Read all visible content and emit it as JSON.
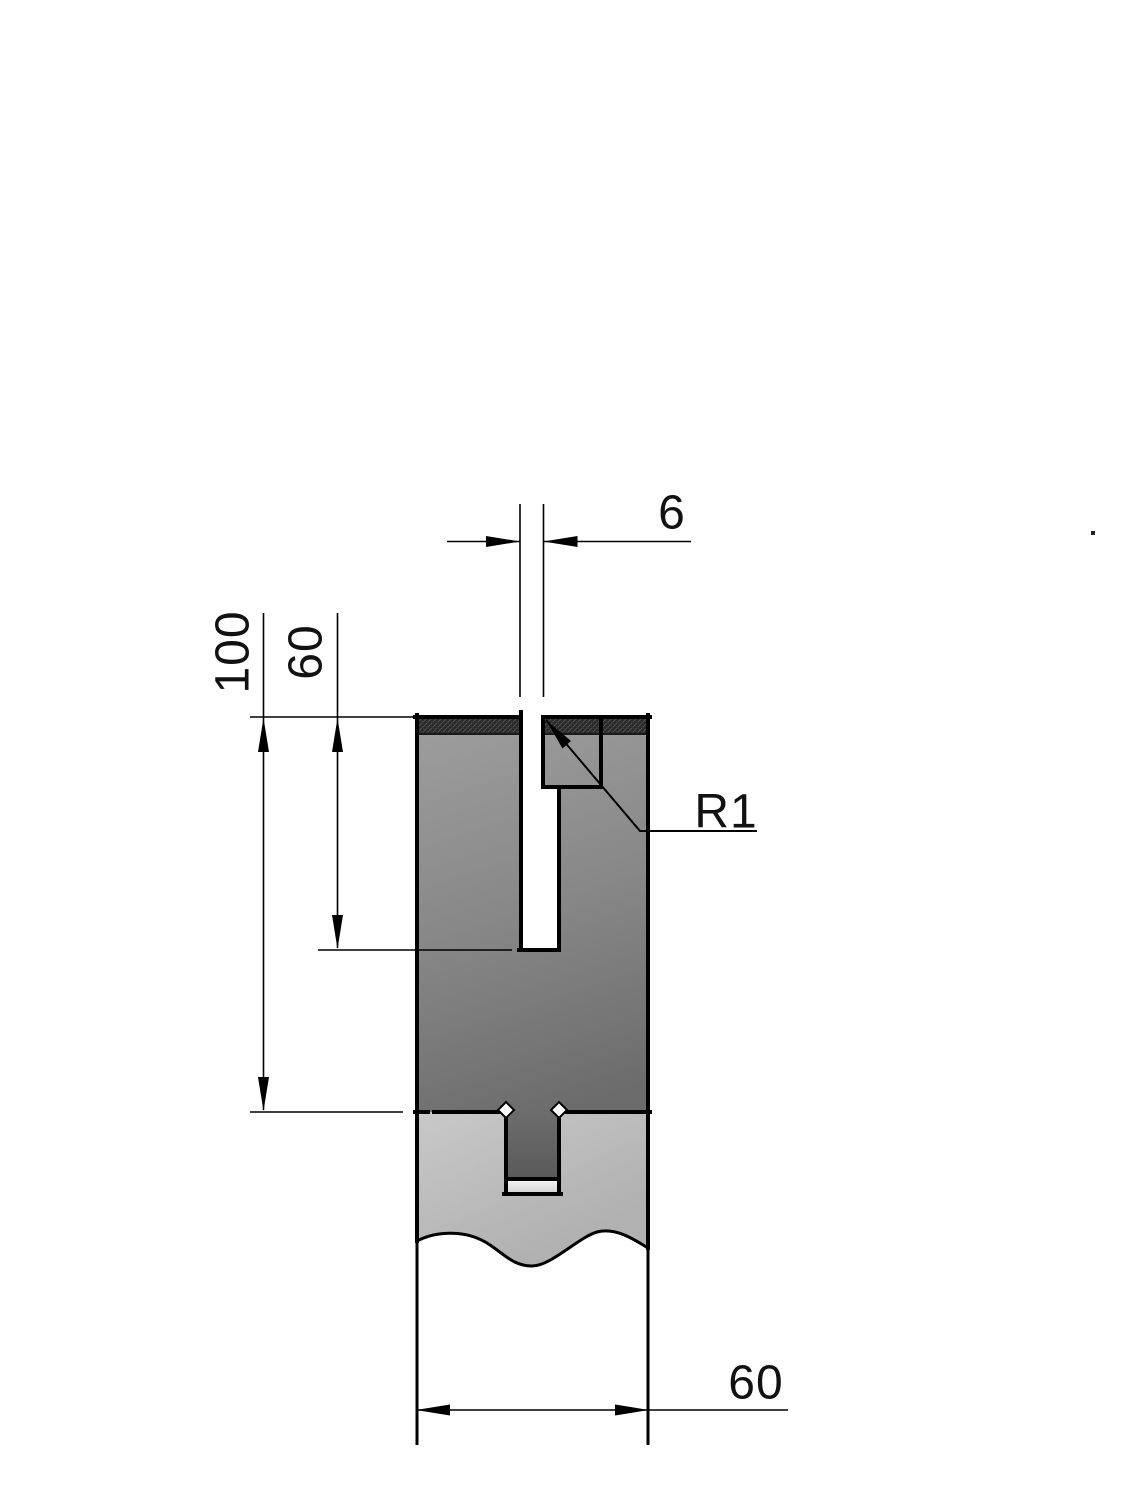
{
  "drawing": {
    "type": "technical-section-drawing",
    "dims": {
      "slot_width": "6",
      "overall_height": "100",
      "slot_depth": "60",
      "body_width": "60",
      "slot_radius": "R1"
    },
    "colors": {
      "background": "#ffffff",
      "line": "#000000",
      "die_gray_top": "#9e9e9e",
      "die_gray_bottom": "#6c6c6c",
      "holder_gray_top": "#c8c8c8",
      "holder_gray_bottom": "#b1b1b1",
      "top_band": "#262626",
      "groove_gap_light": "#ececec"
    }
  }
}
